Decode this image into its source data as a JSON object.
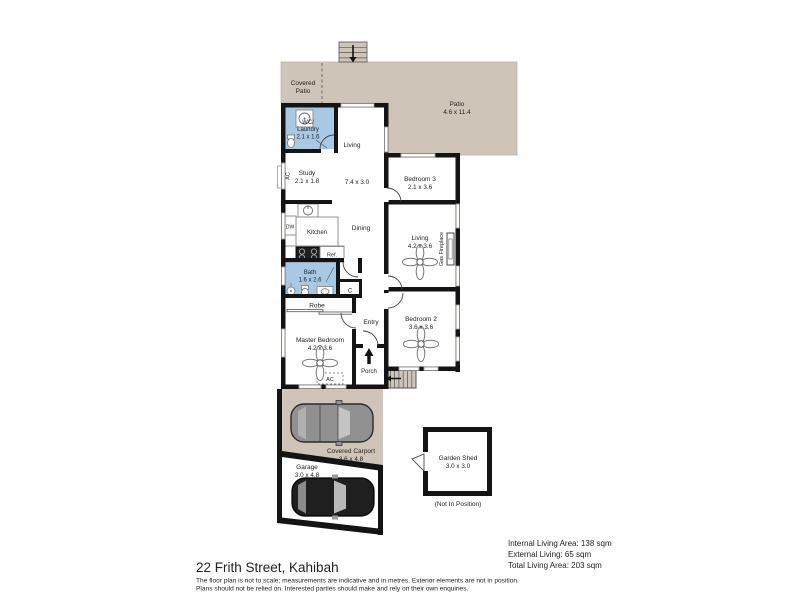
{
  "title": "22 Frith Street, Kahibah",
  "disclaimer": {
    "line1": "The floor plan is not to scale; measurements are indicative and in metres. Exterior elements are not in position.",
    "line2": "Plans should not be relied on. Interested parties should make and rely on their own enquiries."
  },
  "area_summary": {
    "internal": "Internal Living Area: 138 sqm",
    "external": "External Living: 65 sqm",
    "total": "Total Living Area: 203 sqm"
  },
  "colors": {
    "patio_fill": "#cec5b8",
    "wet_area_fill": "#a9c8e4",
    "wall": "#141414",
    "text": "#222222"
  },
  "rooms": {
    "covered_patio": {
      "line1": "Covered",
      "line2": "Patio"
    },
    "patio": {
      "name": "Patio",
      "dims": "4.6 x 11.4"
    },
    "wc_laundry": {
      "line1": "WC/",
      "line2": "Laundry",
      "dims": "2.1 x 1.6"
    },
    "living_main": {
      "name": "Living",
      "dims": "7.4 x 3.0"
    },
    "study": {
      "name": "Study",
      "dims": "2.1 x 1.8"
    },
    "kitchen": {
      "name": "Kitchen"
    },
    "dining": {
      "name": "Dining"
    },
    "bedroom_3": {
      "name": "Bedroom 3",
      "dims": "2.1 x 3.6"
    },
    "living_2": {
      "name": "Living",
      "dims": "4.2 x 3.6"
    },
    "bath": {
      "name": "Bath",
      "dims": "1.6 x 2.6"
    },
    "robe": {
      "name": "Robe"
    },
    "cupboard": {
      "name": "C"
    },
    "entry": {
      "name": "Entry"
    },
    "bedroom_2": {
      "name": "Bedroom 2",
      "dims": "3.6 x 3.6"
    },
    "master_bedroom": {
      "name": "Master Bedroom",
      "dims": "4.2 x 3.6"
    },
    "porch": {
      "name": "Porch"
    },
    "covered_carport": {
      "name": "Covered Carport",
      "dims": "3.6 x 4.8"
    },
    "garage": {
      "name": "Garage",
      "dims": "3.0 x 4.8"
    },
    "garden_shed": {
      "name": "Garden Shed",
      "dims": "3.0 x 3.0",
      "note": "(Not In Position)"
    }
  },
  "fixtures": {
    "gas_fireplace": "Gas Fireplace",
    "ac_study": "AC",
    "ac_master": "AC",
    "dishwasher": "DW",
    "refrigerator": "Ref."
  }
}
